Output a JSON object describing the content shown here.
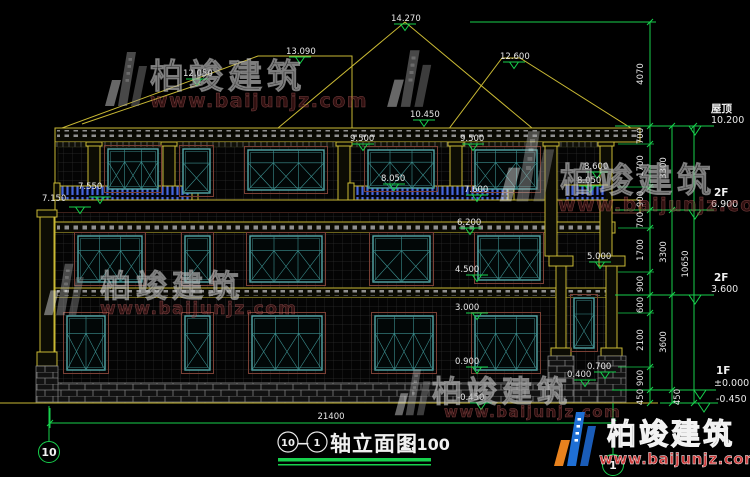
{
  "title": {
    "axis_left": "10",
    "axis_right": "1",
    "separator": "—",
    "name": "轴立面图",
    "scale": "1:100"
  },
  "axis_bubbles": {
    "left": "10",
    "right": "1"
  },
  "watermark": {
    "brand": "柏竣建筑",
    "url": "www.baijunjz.com"
  },
  "logo_block": {
    "brand": "柏竣建筑",
    "url": "www.baijunjz.com"
  },
  "levels": {
    "roof": {
      "label": "屋顶",
      "value": "10.200"
    },
    "f2_upper": {
      "label": "2F",
      "value": "6.900"
    },
    "f2_lower": {
      "label": "2F",
      "value": "3.600"
    },
    "f1": {
      "label": "1F",
      "value": "±0.000"
    },
    "ground": {
      "value": "-0.450"
    }
  },
  "elevations": {
    "peak": "14.270",
    "ridge_left": "13.090",
    "wing_left": "12.050",
    "wing_right": "12.600",
    "eave_center": "10.450",
    "eave_left": "9.500",
    "eave_right": "9.500",
    "balcony_center": "8.050",
    "right_upper": "8.600",
    "right_lower": "8.050",
    "window_right": "7.600",
    "left_rail": "7.550",
    "left_eave": "7.150",
    "band": "6.200",
    "column_cap": "5.000",
    "sill_2f": "4.500",
    "head_1f": "3.000",
    "sill_1f": "0.900",
    "pedestal_high": "0.700",
    "pedestal_low": "0.400",
    "ground": "-0.450"
  },
  "dims": {
    "chain1": [
      "4070",
      "700",
      "1700",
      "900",
      "700",
      "1700",
      "900",
      "600",
      "2100",
      "900",
      "450"
    ],
    "chain2": [
      "3300",
      "3300",
      "3600",
      "450"
    ],
    "total_height": "10650",
    "total_width": "21400"
  },
  "colors": {
    "line_yellow": "#c9b934",
    "line_green": "#17d14d",
    "window_teal": "#56a8a8",
    "baluster_blue": "#4466dd",
    "logo_blue": "#1f6fd4",
    "logo_orange": "#e8821e",
    "url_red": "#cc3b3b"
  }
}
